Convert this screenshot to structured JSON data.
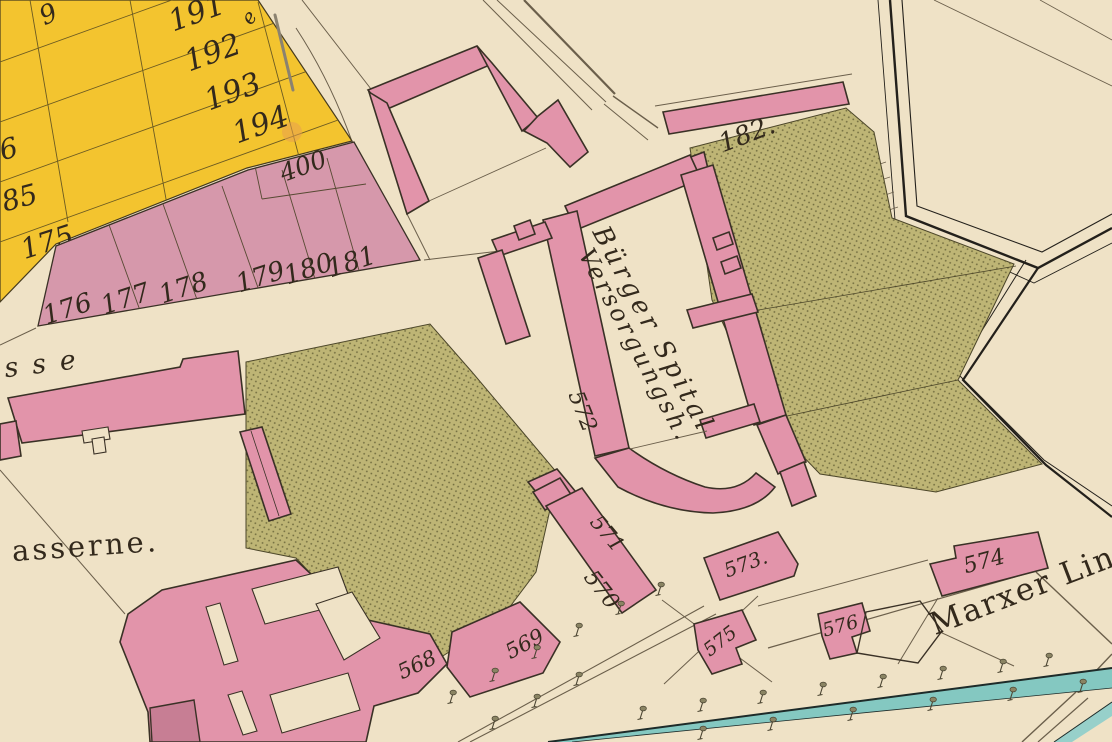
{
  "map": {
    "labels": {
      "n9": "9",
      "n191": "191",
      "n192": "192",
      "n193": "193",
      "n194": "194",
      "n6": "6",
      "n85": "85",
      "n175": "175",
      "n400": "400",
      "n176": "176",
      "n177": "177",
      "n178": "178",
      "n179": "179",
      "n180": "180",
      "n181": "181",
      "n182": "182.",
      "n568": "568",
      "n569": "569",
      "n570": "570",
      "n571": "571",
      "n572": "572",
      "n573": "573.",
      "n574": "574",
      "n575": "575",
      "n576": "576"
    },
    "texts": {
      "hospital_line1": "Bürger Spital",
      "hospital_line2": "Versorgungsh.",
      "marxer": "Marxer Lini",
      "street_sse": "sse",
      "kaserne": "asserne.",
      "e_fragment": "e"
    },
    "colors": {
      "c_parchment": "#EFE2C6",
      "c_yellow": "#F3C42F",
      "c_plot_pink": "#D698AB",
      "c_building_pink": "#E294AA",
      "c_building_dark": "#C77E94",
      "c_garden": "#BEB575",
      "c_garden_dot": "#706b3e",
      "c_garden_edge": "#4a4428",
      "c_stream": "#84C8C1",
      "c_stream_light": "#97D0CA",
      "c_stream_edge": "#1E2B29",
      "c_ink": "#33291C",
      "c_line": "#6B5F4B",
      "c_grid": "#6B5A22",
      "c_wall": "#23201B",
      "c_outline": "#3A3126",
      "c_smudge": "#E8A14F"
    }
  }
}
